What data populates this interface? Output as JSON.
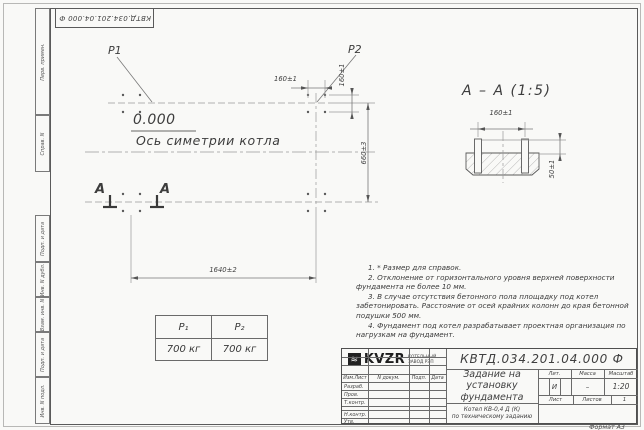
{
  "frame": {
    "top_stamp": "КВТД.034.201.04.000  Ф",
    "margin_labels": {
      "perv_primen": "Перв. примен.",
      "sprav_n": "Справ. N",
      "podp_data_1": "Подп. и дата",
      "inv_dubl": "Инв. N дубл.",
      "vzam_inv": "Взам. инв. N",
      "podp_data_2": "Подп. и дата",
      "inv_podl": "Инв. N подл."
    },
    "format_label": "Формат А3"
  },
  "plan": {
    "p1": "P1",
    "p2": "P2",
    "elevation": "0.000",
    "axis_label": "Ось симетрии котла",
    "dim_top_160": "160±1",
    "dim_side_160": "160±1",
    "dim_660": "660±3",
    "dim_1640": "1640±2",
    "section_mark_left": "А",
    "section_mark_right": "А"
  },
  "section": {
    "title": "А – А (1:5)",
    "dim_160": "160±1",
    "dim_50": "50±1"
  },
  "load_table": {
    "col1_header": "P₁",
    "col2_header": "P₂",
    "col1_value": "700 кг",
    "col2_value": "700 кг"
  },
  "notes": [
    "1. * Размер для справок.",
    "2. Отклонение от горизонтального уровня верхней поверхности фундамента не более 10 мм.",
    "3. В случае отсутствия бетонного пола площадку под котел забетонировать. Расстояние от осей крайних колонн до края бетонной подушки 500 мм.",
    "4. Фундамент под котел разрабатывает проектная организация по нагрузкам на фундамент."
  ],
  "title_block": {
    "doc_number": "КВТД.034.201.04.000  Ф",
    "title": "Задание на\nустановку\nфундамента",
    "subtitle": "Котел  КВ-0,4  Д  (К)\nпо техническому заданию",
    "cols": {
      "izm": "Изм.Лист",
      "doc": "N докум.",
      "podp": "Подп.",
      "data": "Дата"
    },
    "rows": [
      "Разраб.",
      "Пров.",
      "Т.контр.",
      "",
      "Н.контр.",
      "Утв."
    ],
    "lit_header": "Лит.",
    "mass_header": "Масса",
    "scale_header": "Масштаб",
    "lit_value": "И",
    "mass_value": "–",
    "scale_value": "1:20",
    "sheet_label": "Лист",
    "sheets_label": "Листов",
    "sheets_value": "1",
    "logo_text": "KVZR",
    "logo_sub": "КОТЕЛЬНЫЙ\nЗАВОД РЭП"
  }
}
